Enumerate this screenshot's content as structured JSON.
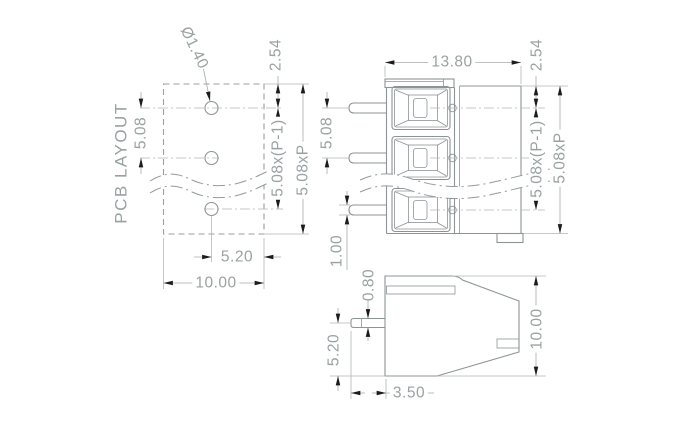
{
  "drawing": {
    "views": {
      "pcb": {
        "title": "PCB LAYOUT",
        "hole_diameter": "Ø1.40",
        "row_offset": "2.54",
        "pitch": "5.08",
        "pole_span": "5.08x(P-1)",
        "total_span": "5.08xP",
        "hole_to_edge": "5.20",
        "footprint_width": "10.00"
      },
      "front": {
        "body_width": "13.80",
        "row_offset": "2.54",
        "pin_pitch": "5.08",
        "pole_span": "5.08x(P-1)",
        "total_span": "5.08xP",
        "pin_width": "1.00"
      },
      "side": {
        "pin_thickness": "0.80",
        "pin_to_base": "5.20",
        "pin_length": "3.50",
        "body_height": "10.00"
      }
    }
  }
}
